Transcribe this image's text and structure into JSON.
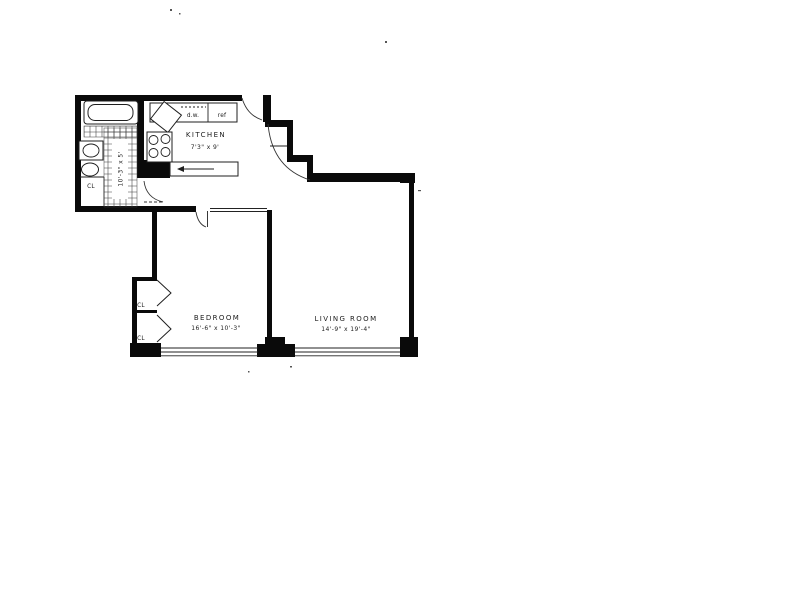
{
  "page": {
    "background": "#ffffff",
    "drawing_type": "apartment floor plan scan"
  },
  "plan": {
    "kitchen": {
      "label": "KITCHEN",
      "dims": "7'3\" x 9'"
    },
    "bedroom": {
      "label": "BEDROOM",
      "dims": "16'-6\" x 10'-3\""
    },
    "living_room": {
      "label": "LIVING ROOM",
      "dims": "14'-9\" x 19'-4\""
    },
    "gallery": {
      "dims": "10'-3\" x 5'"
    },
    "appliances": {
      "dishwasher": "d.w.",
      "refrigerator": "ref"
    },
    "closets": {
      "foyer": "CL",
      "bedroom_upper": "CL",
      "bedroom_lower": "CL"
    },
    "colors": {
      "wall": "#0a0a0a",
      "paper": "#ffffff",
      "ink": "#1c1c1c"
    }
  }
}
